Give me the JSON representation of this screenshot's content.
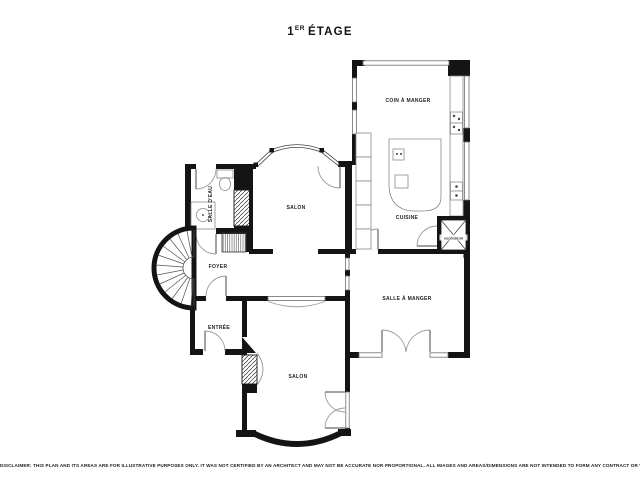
{
  "title": {
    "num": "1",
    "sup": "ER",
    "rest": "ÉTAGE"
  },
  "rooms": {
    "coin_a_manger": "COIN À MANGER",
    "cuisine": "CUISINE",
    "ascenseur": "ASCENSEUR",
    "salon_middle": "SALON",
    "salle_deau": "SALLE D'EAU",
    "foyer": "FOYER",
    "entree": "ENTRÉE",
    "salle_a_manger": "SALLE À MANGER",
    "salon_bottom": "SALON"
  },
  "disclaimer": "DISCLAIMER: THIS PLAN AND ITS AREAS ARE FOR ILLUSTRATIVE PURPOSES ONLY. IT WAS NOT CERTIFIED BY AN ARCHITECT AND MAY NOT BE ACCURATE NOR PROPORTIONAL. ALL IMAGES AND AREAS/DIMENSIONS ARE NOT INTENDED TO FORM ANY CONTRACT OR WARRANTY.",
  "colors": {
    "wall": "#141414",
    "thin_line": "#8a8a8a",
    "background": "#ffffff"
  }
}
